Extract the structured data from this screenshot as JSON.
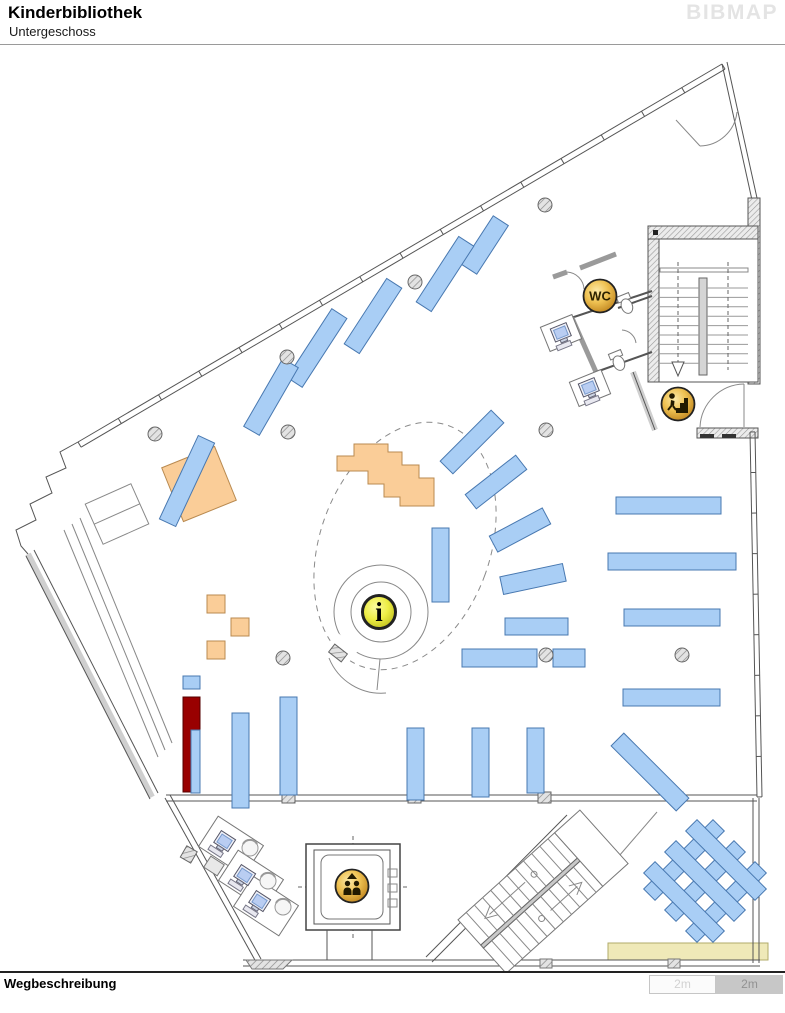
{
  "header": {
    "title": "Kinderbibliothek",
    "subtitle": "Untergeschoss",
    "logo": "BIBMAP"
  },
  "footer": {
    "directions_label": "Wegbeschreibung"
  },
  "scale_bar": {
    "segment1_label": "2m",
    "segment2_label": "2m"
  },
  "map": {
    "colors": {
      "shelf_fill": "#A9CEF5",
      "shelf_stroke": "#4878B0",
      "wood_fill": "#FACD98",
      "wood_stroke": "#B98A50",
      "highlight": "#990000",
      "gold": "#E8B33C",
      "info_yellow": "#EDED45",
      "floor_bar": "#EFE9B8"
    },
    "icons": [
      {
        "type": "wc",
        "label": "WC",
        "x": 600,
        "y": 296
      },
      {
        "type": "stairs-down",
        "x": 678,
        "y": 404
      },
      {
        "type": "info",
        "label": "i",
        "x": 379,
        "y": 612
      },
      {
        "type": "elevator",
        "x": 352,
        "y": 886
      }
    ],
    "shelves_rotated": [
      {
        "cx": 485,
        "cy": 245,
        "len": 58,
        "w": 18,
        "rot": 33
      },
      {
        "cx": 445,
        "cy": 274,
        "len": 78,
        "w": 18,
        "rot": 33
      },
      {
        "cx": 373,
        "cy": 316,
        "len": 78,
        "w": 18,
        "rot": 33
      },
      {
        "cx": 317,
        "cy": 348,
        "len": 82,
        "w": 18,
        "rot": 33
      },
      {
        "cx": 271,
        "cy": 397,
        "len": 78,
        "w": 18,
        "rot": 30
      },
      {
        "cx": 187,
        "cy": 481,
        "len": 92,
        "w": 18,
        "rot": 25
      },
      {
        "cx": 472,
        "cy": 442,
        "len": 72,
        "w": 18,
        "rot": 45
      },
      {
        "cx": 496,
        "cy": 482,
        "len": 64,
        "w": 18,
        "rot": 52
      },
      {
        "cx": 520,
        "cy": 530,
        "len": 60,
        "w": 18,
        "rot": 62
      },
      {
        "cx": 533,
        "cy": 579,
        "len": 64,
        "w": 18,
        "rot": 78
      },
      {
        "cx": 650,
        "cy": 772,
        "len": 92,
        "w": 18,
        "rot": -45
      },
      {
        "cx": 684,
        "cy": 860,
        "len": 98,
        "w": 16,
        "rot": 45
      },
      {
        "cx": 705,
        "cy": 881,
        "len": 98,
        "w": 16,
        "rot": 45
      },
      {
        "cx": 726,
        "cy": 902,
        "len": 98,
        "w": 16,
        "rot": 45
      },
      {
        "cx": 684,
        "cy": 902,
        "len": 98,
        "w": 16,
        "rot": -45
      },
      {
        "cx": 705,
        "cy": 881,
        "len": 98,
        "w": 16,
        "rot": -45
      },
      {
        "cx": 726,
        "cy": 860,
        "len": 98,
        "w": 16,
        "rot": -45
      }
    ],
    "shelves_rect": [
      {
        "x": 432,
        "y": 528,
        "w": 17,
        "h": 74
      },
      {
        "x": 505,
        "y": 618,
        "w": 63,
        "h": 17
      },
      {
        "x": 462,
        "y": 649,
        "w": 75,
        "h": 18
      },
      {
        "x": 553,
        "y": 649,
        "w": 32,
        "h": 18
      },
      {
        "x": 616,
        "y": 497,
        "w": 105,
        "h": 17
      },
      {
        "x": 608,
        "y": 553,
        "w": 128,
        "h": 17
      },
      {
        "x": 624,
        "y": 609,
        "w": 96,
        "h": 17
      },
      {
        "x": 623,
        "y": 689,
        "w": 97,
        "h": 17
      },
      {
        "x": 232,
        "y": 713,
        "w": 17,
        "h": 95
      },
      {
        "x": 280,
        "y": 697,
        "w": 17,
        "h": 98
      },
      {
        "x": 407,
        "y": 728,
        "w": 17,
        "h": 72
      },
      {
        "x": 472,
        "y": 728,
        "w": 17,
        "h": 69
      },
      {
        "x": 527,
        "y": 728,
        "w": 17,
        "h": 65
      },
      {
        "x": 183,
        "y": 676,
        "w": 17,
        "h": 13
      },
      {
        "x": 191,
        "y": 730,
        "w": 9,
        "h": 63
      }
    ],
    "wood_blocks": [
      {
        "cx": 199,
        "cy": 484,
        "w": 57,
        "h": 58,
        "rot": -22
      },
      {
        "cx": 216,
        "cy": 604,
        "w": 18,
        "h": 18,
        "rot": 0
      },
      {
        "cx": 240,
        "cy": 627,
        "w": 18,
        "h": 18,
        "rot": 0
      },
      {
        "cx": 216,
        "cy": 650,
        "w": 18,
        "h": 18,
        "rot": 0
      }
    ],
    "highlight_shelf": {
      "x": 183,
      "y": 697,
      "w": 17,
      "h": 95
    },
    "columns": [
      {
        "x": 545,
        "y": 205
      },
      {
        "x": 415,
        "y": 282
      },
      {
        "x": 287,
        "y": 357
      },
      {
        "x": 288,
        "y": 432
      },
      {
        "x": 155,
        "y": 434
      },
      {
        "x": 546,
        "y": 430
      },
      {
        "x": 546,
        "y": 655
      },
      {
        "x": 682,
        "y": 655
      },
      {
        "x": 283,
        "y": 658
      }
    ],
    "tables": [
      {
        "cx": 231,
        "cy": 846,
        "w": 54,
        "h": 36,
        "rot": 33
      },
      {
        "cx": 251,
        "cy": 880,
        "w": 54,
        "h": 36,
        "rot": 33
      },
      {
        "cx": 266,
        "cy": 906,
        "w": 54,
        "h": 36,
        "rot": 33
      },
      {
        "cx": 214,
        "cy": 866,
        "w": 16,
        "h": 13,
        "rot": 33,
        "fill": "#e8e8e8"
      },
      {
        "cx": 561,
        "cy": 333,
        "w": 34,
        "h": 26,
        "rot": -22
      },
      {
        "cx": 590,
        "cy": 388,
        "w": 34,
        "h": 26,
        "rot": -22
      }
    ],
    "computers": [
      {
        "x": 562,
        "y": 334,
        "rot": -22
      },
      {
        "x": 590,
        "y": 389,
        "rot": -22
      },
      {
        "x": 224,
        "y": 843,
        "rot": 33
      },
      {
        "x": 244,
        "y": 877,
        "rot": 33
      },
      {
        "x": 259,
        "y": 903,
        "rot": 33
      }
    ],
    "chairs": [
      {
        "x": 250,
        "y": 848
      },
      {
        "x": 268,
        "y": 881
      },
      {
        "x": 283,
        "y": 907
      }
    ]
  }
}
